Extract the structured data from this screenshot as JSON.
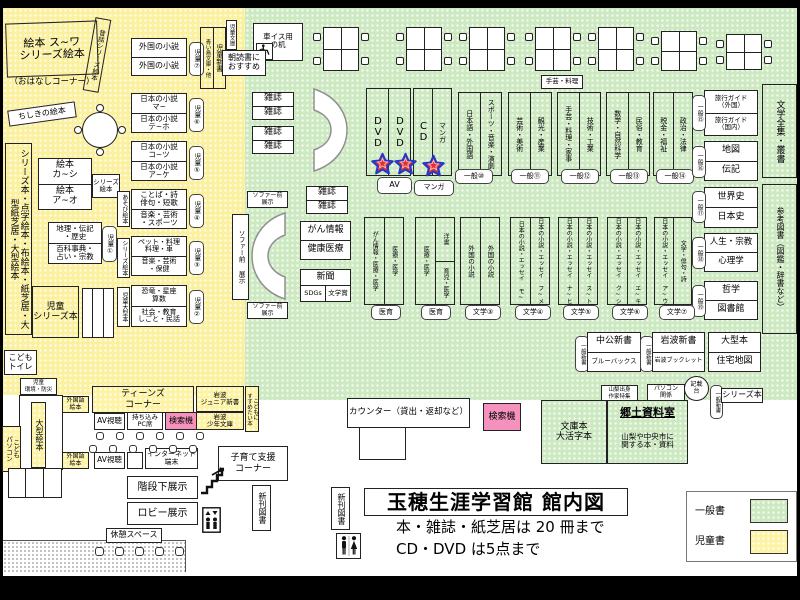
{
  "colors": {
    "children_area_yellow": "#fbf09e",
    "general_area_green": "#cde9c2",
    "search_machine_pink": "#f492bd",
    "star_red": "#e03030",
    "star_blue": "#2438c8"
  },
  "header": {
    "title": "玉穂生涯学習館 館内図",
    "rule_books": "本・雑誌・紙芝居は 20 冊まで",
    "rule_av": "CD・DVD は5点まで"
  },
  "legend": {
    "general": "一般書",
    "children": "児童書"
  },
  "children": {
    "ehon_suwa": "絵本 ス~ワ\nシリーズ絵本",
    "ohanashi": "（おはなしコーナー）",
    "mukashibanashi": "昔話シリーズ絵本",
    "chishiki_ehon": "ちしきの絵本",
    "wall_series": "シリーズ本・点字絵本・布絵本・紙芝居・大型紙芝居・大型絵本",
    "ehon_ka_shi": "絵本\nカ~シ",
    "ehon_a_o": "絵本\nア~オ",
    "series_ehon": "シリーズ\n絵本",
    "chiri_denki": "地理・伝記\n・歴史",
    "hyakka": "百科事典・\n占い・宗教",
    "jido1": "児童①",
    "jido2": "児童②",
    "jido3": "児童③",
    "jido4": "児童④",
    "jido5": "児童⑤",
    "jido6": "児童⑥",
    "jido7": "児童⑦",
    "jido_series": "児童\nシリーズ本",
    "gaikoku_shosetsu": "外国の小説",
    "nihon_ma": "日本の小説\nマ~",
    "nihon_teho": "日本の小説\nテ~ホ",
    "nihon_kotsu": "日本の小説\nコ~ツ",
    "nihon_ake": "日本の小説\nア~ケ",
    "kotoba_shi": "ことば・詩\n俳句・短歌",
    "ongaku_sports": "音楽・芸術\n・スポーツ",
    "asobi_ehon": "あそび絵本",
    "pet_ryori": "ペット・料理\n料理・車",
    "ongaku_hoken": "音楽・芸術\n・保健",
    "series_ehon_v": "シリーズ絵本",
    "kyoryu": "恐竜・星座\n算数",
    "shakai": "社会・教育\nしごと・民話",
    "jido_ogata": "児童大型本",
    "aoitori": "青い鳥文庫・他",
    "jido_shinsho": "児童新書",
    "jido_bunko": "児童文庫",
    "asadoku": "朝読書に\nおすすめ",
    "kodomo_toilet": "こども\nトイレ",
    "jido_kankyo": "児童\n環境・防災",
    "ogata_ehon": "大型絵本",
    "kodomo_pc": "こども\nパソコン"
  },
  "general": {
    "kurumaisu": "車イス用\nの机",
    "zasshi": "雑誌",
    "shugei_ryori": "手芸・料理",
    "dvd": "DVD",
    "cd": "CD",
    "manga": "マンガ",
    "av": "AV",
    "manga_badge": "マンガ",
    "sofa_front": "ソファー前\n展示",
    "sofa_front_v": "ソファー前 展示",
    "gan_joho": "がん情報",
    "kenko_iryo": "健康医療",
    "shinbun": "新聞",
    "sdgs": "SDGs",
    "bungakusho": "文学賞",
    "nihongo": "日本語・外国語",
    "sports_ongaku": "スポーツ・音楽・演劇",
    "ippan10": "一般⑩",
    "geijutsu": "芸術・美術",
    "kanko": "観光・産業",
    "ippan11": "一般⑪",
    "shugei_kaji": "手芸・料理・家事",
    "gijutsu": "技術・工業",
    "ippan12": "一般⑫",
    "sugaku": "数学・自然科学",
    "minzoku": "民俗・教育",
    "ippan13": "一般⑬",
    "zeikin": "税金・福祉",
    "seiji": "政治・法律",
    "ippan14": "一般⑭",
    "ryoko_gaikoku": "旅行ガイド\n（外国）",
    "ryoko_kokunai": "旅行ガイド\n（国内）",
    "ippan15": "一般⑮",
    "chizu": "地図",
    "denki": "伝記",
    "ippan16": "一般⑯",
    "sekaishi": "世界史",
    "nihonshi": "日本史",
    "ippan17": "一般⑰",
    "jinsei": "人生・宗教",
    "shinrigaku": "心理学",
    "ippan18": "一般⑱",
    "tetsugaku": "哲学",
    "toshokan": "図書館",
    "ippan19": "一般⑲",
    "bungaku_zenshu": "文学全集・叢書",
    "sanko_tosho": "参考図書（図鑑・辞書など）",
    "gan_iryo": "がん情報・医療・医学",
    "iryo_igaku": "医療・医学",
    "iiku": "医育",
    "yosho": "洋書",
    "ikuji_igaku": "育児・医学",
    "gaikoku_shosetsu": "外国の小説",
    "bungaku3": "文学③",
    "essay_mo": "日本の小説・エッセイ モ~",
    "essay_fume": "日本の小説・エッセイ フ~メ",
    "bungaku4": "文学④",
    "essay_nahi": "日本の小説・エッセイ ナ~ヒ",
    "essay_suto": "日本の小説・エッセイ ス~ト",
    "bungaku5": "文学⑤",
    "essay_kushi": "日本の小説・エッセイ ク~シ",
    "essay_eki": "日本の小説・エッセイ エ~キ",
    "bungaku6": "文学⑥",
    "essay_au": "日本の小説・エッセイ ア~ウ",
    "bungaku_haiku": "文学・俳句・詩",
    "bungaku7": "文学⑦",
    "ippan_shinsho": "一般新書",
    "chuko": "中公新書",
    "bluebacks": "ブルーバックス",
    "iwanami_shinsho": "岩波新書",
    "iwanami_booklet": "岩波ブックレット",
    "ogata_bon": "大型本",
    "jutaku_chizu": "住宅地図",
    "yamanashi": "山梨出身\n作家特集",
    "pc_kankei": "パソコン\n関係",
    "kisaidai": "記載\n台",
    "series_bon": "シリーズ本"
  },
  "counter": {
    "label": "カウンター（貸出・返却など）",
    "kensakuki": "検索機"
  },
  "rooms": {
    "bunko": "文庫本\n大活字本",
    "kyodo_title": "郷土資料室",
    "kyodo_desc": "山梨や中央市に\n関する本・資料"
  },
  "teens": {
    "gaikokugo_ehon": "外国語\n絵本",
    "corner": "ティーンズ\nコーナー",
    "av_shicho": "AV視聴",
    "pc_seki": "持ち込み\nPC席",
    "kensakuki": "検索機",
    "iwanami_jr": "岩波\nジュニア新書",
    "iwanami_shonen": "岩波\n少年文庫",
    "susume": "こどもに\nすすめたい本",
    "internet": "インターネット\n端末",
    "kosodate": "子育て支援\nコーナー"
  },
  "facilities": {
    "shinkan": "新刊図書",
    "kaidan_shita": "階段下展示",
    "lobby": "ロビー展示",
    "kyukei": "休憩スペース",
    "icons": {
      "wheelchair": "wheelchair-icon",
      "stairs": "stairs-icon",
      "elevator": "elevator-icon",
      "restroom": "restroom-icon",
      "star": "star-marker-icon",
      "sofa": "crescent-sofa"
    }
  }
}
